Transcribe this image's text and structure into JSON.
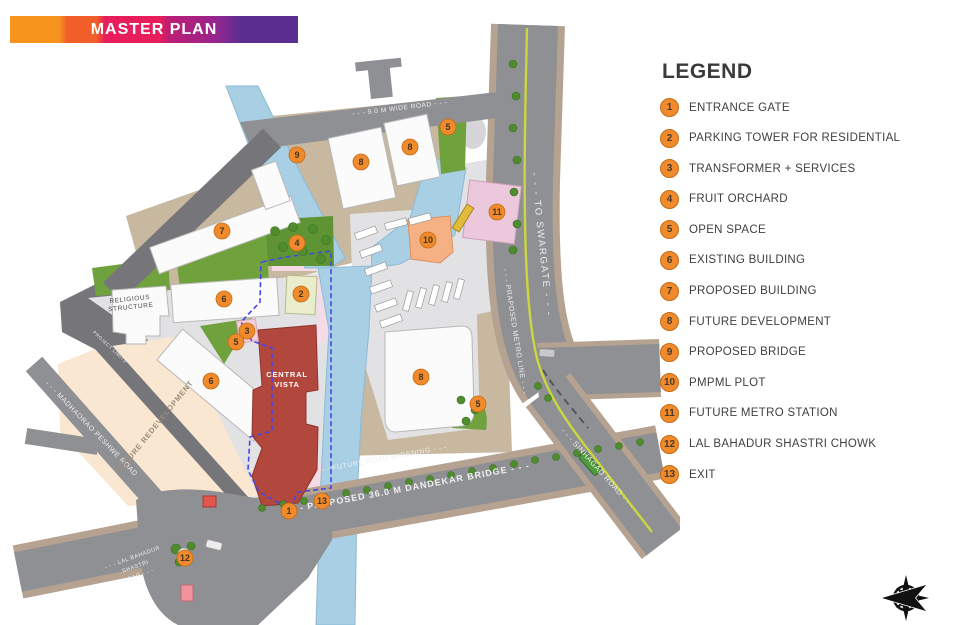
{
  "title": {
    "text": "MASTER PLAN"
  },
  "legend": {
    "heading": "LEGEND",
    "items": [
      {
        "num": "1",
        "label": "ENTRANCE GATE"
      },
      {
        "num": "2",
        "label": "PARKING TOWER FOR RESIDENTIAL"
      },
      {
        "num": "3",
        "label": "TRANSFORMER + SERVICES"
      },
      {
        "num": "4",
        "label": "FRUIT ORCHARD"
      },
      {
        "num": "5",
        "label": "OPEN SPACE"
      },
      {
        "num": "6",
        "label": "EXISTING BUILDING"
      },
      {
        "num": "7",
        "label": "PROPOSED BUILDING"
      },
      {
        "num": "8",
        "label": "FUTURE DEVELOPMENT"
      },
      {
        "num": "9",
        "label": "PROPOSED BRIDGE"
      },
      {
        "num": "10",
        "label": "PMPML PLOT"
      },
      {
        "num": "11",
        "label": "FUTURE METRO STATION"
      },
      {
        "num": "12",
        "label": "LAL BAHADUR SHASTRI CHOWK"
      },
      {
        "num": "13",
        "label": "EXIT"
      }
    ]
  },
  "map": {
    "markers": [
      {
        "num": "1",
        "x": 289,
        "y": 511
      },
      {
        "num": "2",
        "x": 301,
        "y": 294
      },
      {
        "num": "3",
        "x": 247,
        "y": 331
      },
      {
        "num": "4",
        "x": 297,
        "y": 243
      },
      {
        "num": "5",
        "x": 448,
        "y": 127
      },
      {
        "num": "5",
        "x": 236,
        "y": 342
      },
      {
        "num": "5",
        "x": 478,
        "y": 404
      },
      {
        "num": "6",
        "x": 224,
        "y": 299
      },
      {
        "num": "6",
        "x": 211,
        "y": 381
      },
      {
        "num": "7",
        "x": 222,
        "y": 231
      },
      {
        "num": "8",
        "x": 361,
        "y": 162
      },
      {
        "num": "8",
        "x": 410,
        "y": 147
      },
      {
        "num": "8",
        "x": 421,
        "y": 377
      },
      {
        "num": "9",
        "x": 297,
        "y": 155
      },
      {
        "num": "10",
        "x": 428,
        "y": 240
      },
      {
        "num": "11",
        "x": 497,
        "y": 212
      },
      {
        "num": "12",
        "x": 185,
        "y": 558
      },
      {
        "num": "13",
        "x": 322,
        "y": 501
      }
    ],
    "labels": [
      {
        "name": "road-label-9m-wide",
        "text": "- - -  9.0 M WIDE ROAD  - - -",
        "x": 400,
        "y": 110,
        "rot": -7,
        "size": 6.5,
        "cls": ""
      },
      {
        "name": "road-label-to-swargate",
        "text": "- - -  TO SWARGATE  - - -",
        "x": 539,
        "y": 245,
        "rot": 84,
        "size": 9.5,
        "cls": "sp"
      },
      {
        "name": "road-label-metro-line",
        "text": "- - - PRAPOSED METRO LINE - - -",
        "x": 513,
        "y": 332,
        "rot": 81,
        "size": 7,
        "cls": ""
      },
      {
        "name": "road-label-sinhagad",
        "text": "- - - SINHAGAD ROAD - - -",
        "x": 596,
        "y": 470,
        "rot": 48,
        "size": 7.5,
        "cls": ""
      },
      {
        "name": "road-label-dandekar",
        "text": "- - -  PROPOSED 36.0 M DANDEKAR BRIDGE  - - -",
        "x": 408,
        "y": 491,
        "rot": -10.5,
        "size": 9,
        "cls": "b"
      },
      {
        "name": "road-label-road-widening",
        "text": "- - - FUTURE ROAD WIDENING - - -",
        "x": 382,
        "y": 461,
        "rot": -10.5,
        "size": 7,
        "cls": ""
      },
      {
        "name": "road-label-madhaorao",
        "text": "- - -  MADHAORAO PESHWE ROAD",
        "x": 90,
        "y": 430,
        "rot": 46,
        "size": 7,
        "cls": ""
      },
      {
        "name": "road-label-lal-bahadur-1",
        "text": "- - - LAL BAHADUR",
        "x": 133,
        "y": 559,
        "rot": -20,
        "size": 5.5,
        "cls": ""
      },
      {
        "name": "road-label-lal-bahadur-2",
        "text": "SHASTRI",
        "x": 136,
        "y": 568,
        "rot": -20,
        "size": 5.5,
        "cls": ""
      },
      {
        "name": "road-label-lal-bahadur-3",
        "text": "ROAD - - -",
        "x": 139,
        "y": 577,
        "rot": -20,
        "size": 5.5,
        "cls": ""
      },
      {
        "name": "label-religious-1",
        "text": "RELIGIOUS",
        "x": 130,
        "y": 301,
        "rot": -6,
        "size": 6.5,
        "cls": "dark"
      },
      {
        "name": "label-religious-2",
        "text": "STRUCTURE",
        "x": 131,
        "y": 309,
        "rot": -6,
        "size": 6.5,
        "cls": "dark"
      },
      {
        "name": "label-project-limits",
        "text": "PROJECT LIMITS",
        "x": 109,
        "y": 348,
        "rot": 43,
        "size": 4.5,
        "cls": ""
      },
      {
        "name": "label-central-vista-1",
        "text": "CENTRAL",
        "x": 287,
        "y": 377,
        "rot": 0,
        "size": 7.5,
        "cls": "wb"
      },
      {
        "name": "label-central-vista-2",
        "text": "VISTA",
        "x": 287,
        "y": 387,
        "rot": 0,
        "size": 7.5,
        "cls": "wb"
      },
      {
        "name": "label-future-redevelopment",
        "text": "FUTURE REDEVELOPMENT",
        "x": 157,
        "y": 428,
        "rot": -51,
        "size": 7.5,
        "cls": "muted"
      }
    ]
  },
  "colors": {
    "title_gradient_stops": [
      "#F7941E 0%",
      "#F7941E 17%",
      "#F15E29 20%",
      "#F15E29 30%",
      "#E81D5C 33%",
      "#E81D5C 52%",
      "#BE1E74 55%",
      "#A02288 68%",
      "#93278F 72%",
      "#5C2D91 80%",
      "#5C2D91 100%"
    ],
    "vars": {
      "marker": "#EF8B2D",
      "marker_edge": "#C76A12",
      "marker_text": "#4A3320",
      "water": "#A9CFE5",
      "water_edge": "#8ABBD6",
      "road": "#8F9093",
      "road_dark": "#76767A",
      "sidewalk": "#B5A290",
      "tan": "#C7B89F",
      "pavement": "#E2E2E4",
      "pavement2": "#D6D6D8",
      "peach": "#FAE7D1",
      "green": "#6FA23C",
      "green_dark": "#4E8C2E",
      "green_edge": "#3C6E22",
      "red_bldg": "#B2473D",
      "red_edge": "#8E352D",
      "pink": "#F5DBE8",
      "metro_pink": "#ECC8DC",
      "pale_lime": "#E9EDCB",
      "salmon": "#F5B183",
      "boundary": "#4646E8",
      "metro_line": "#CCD63F",
      "bldg": "#FBFBFB",
      "bldg_edge": "#B8B8B8",
      "label_light": "#EFEFEF",
      "label_dark": "#4A4A4A",
      "label_muted": "#9A8A78",
      "legend_text": "#3F3F3F",
      "heading": "#3A3A3A"
    }
  }
}
